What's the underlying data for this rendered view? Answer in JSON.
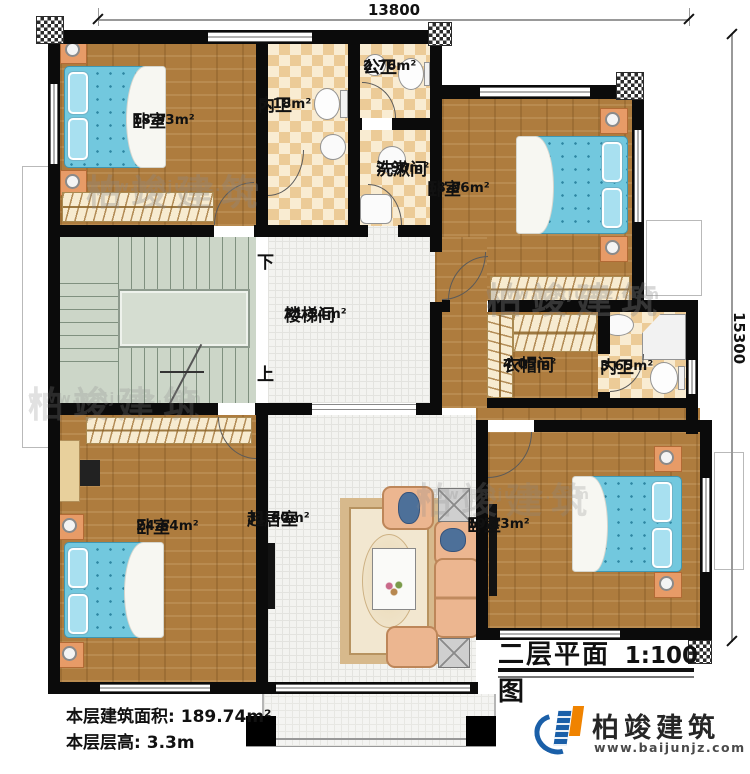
{
  "dimensions": {
    "width_top": "13800",
    "height_right": "15300"
  },
  "rooms": {
    "bedroom_tl": {
      "name": "卧室",
      "area": "18.93m²"
    },
    "ensuite_tl": {
      "name": "内卫",
      "area": "5.18m²"
    },
    "public_bath": {
      "name": "公卫",
      "area": "2.76m²"
    },
    "washroom": {
      "name": "洗漱间",
      "area": "2.90m²"
    },
    "bedroom_tr": {
      "name": "卧室",
      "area": "18.06m²"
    },
    "stair_hall": {
      "name": "楼梯间",
      "area": "31.54m²"
    },
    "cloakroom": {
      "name": "衣帽间",
      "area": "4.05m²"
    },
    "ensuite_mr": {
      "name": "内卫",
      "area": "3.65m²"
    },
    "bedroom_bl": {
      "name": "卧室",
      "area": "24.64m²"
    },
    "living_room": {
      "name": "起居室",
      "area": "31.60m²"
    },
    "bedroom_br": {
      "name": "卧室",
      "area": "19.43m²"
    }
  },
  "stairs": {
    "down_label": "下",
    "up_label": "上"
  },
  "title": {
    "text": "二层平面图",
    "scale": "1:100"
  },
  "stats": {
    "area_label": "本层建筑面积:",
    "area_value": "189.74m²",
    "height_label": "本层层高:",
    "height_value": "3.3m"
  },
  "branding": {
    "company": "柏竣建筑",
    "website": "www.baijunjz.com"
  },
  "watermark": {
    "company": "柏竣建筑",
    "website": "www.baijunjz.com"
  },
  "colors": {
    "wall": "#0b0b0b",
    "wood": "#ae7c3e",
    "bed": "#72c8de",
    "logo_blue": "#1a5fa8",
    "logo_orange": "#f08300"
  }
}
